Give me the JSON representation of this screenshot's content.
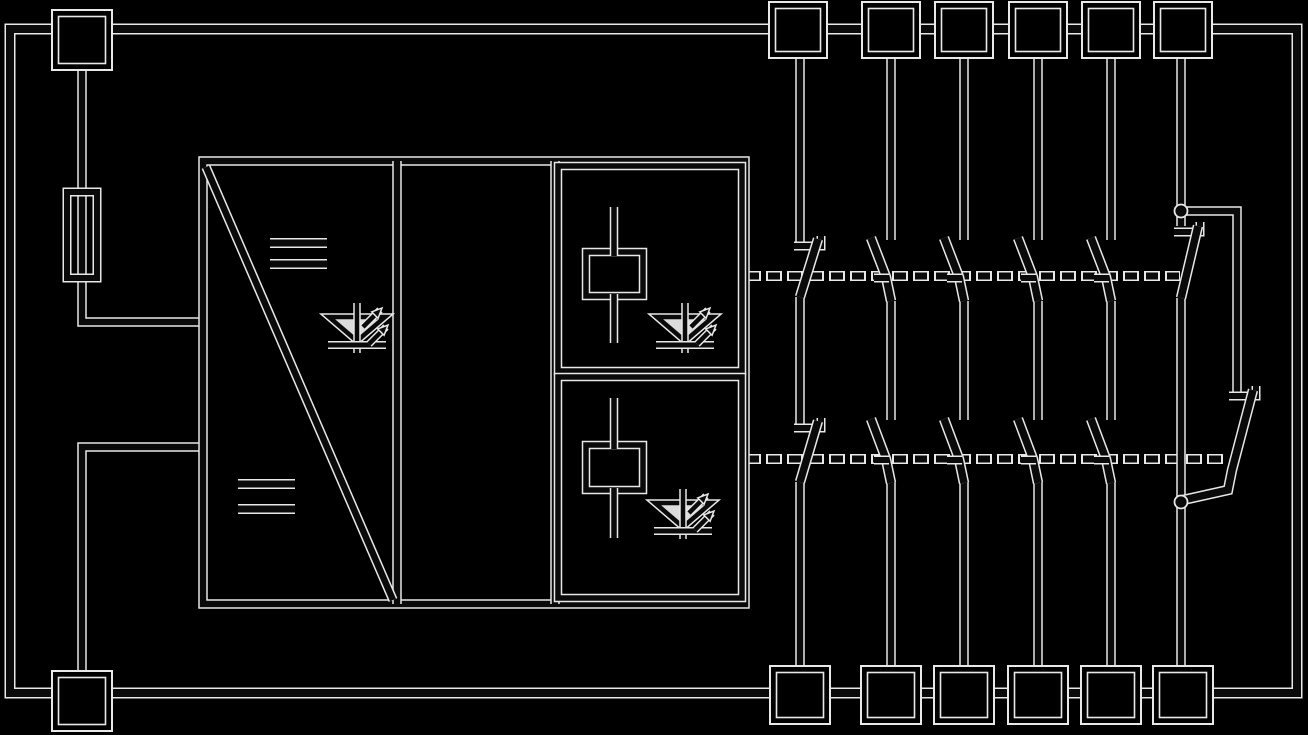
{
  "canvas": {
    "width": 1308,
    "height": 735,
    "background_color": "#000000",
    "ink_color": "#0a0a0a",
    "halo_color": "#e8e8e8",
    "led_fill_color": "#dcdcdc",
    "halo_extra_width": 3
  },
  "schematic": {
    "border": {
      "name": "outer-border",
      "d": "M10,29 L1297,29 L1297,693 L10,693 Z",
      "w": 8
    },
    "dashed_links": [
      {
        "name": "actuator-link-relay1",
        "d": "M747,276 L1180,276",
        "w": 7,
        "ink_dash": "12 9",
        "halo_dash": "16 5",
        "halo_offset": 2
      },
      {
        "name": "actuator-link-relay2",
        "d": "M747,459 L1228,459",
        "w": 7,
        "ink_dash": "12 9",
        "halo_dash": "16 5",
        "halo_offset": 2
      }
    ],
    "wires": [
      {
        "name": "supply-feed-wire",
        "d": "M82,66 L82,322 L204,322",
        "w": 6.5
      },
      {
        "name": "supply-return-wire",
        "d": "M204,447 L82,447 L82,675",
        "w": 6.5
      },
      {
        "name": "col1-top-wire",
        "d": "M800,58 L800,246",
        "w": 6.5
      },
      {
        "name": "col1-mid-wire",
        "d": "M800,297 L800,428",
        "w": 6.5
      },
      {
        "name": "col1-bottom-wire",
        "d": "M800,482 L800,670",
        "w": 6.5
      },
      {
        "name": "col2-top-wire",
        "d": "M891,58 L891,240",
        "w": 6.5
      },
      {
        "name": "col2-mid-wire",
        "d": "M891,301 L891,420",
        "w": 6.5
      },
      {
        "name": "col2-bottom-wire",
        "d": "M891,482 L891,670",
        "w": 6.5
      },
      {
        "name": "col3-top-wire",
        "d": "M964,58 L964,240",
        "w": 6.5
      },
      {
        "name": "col3-mid-wire",
        "d": "M964,301 L964,420",
        "w": 6.5
      },
      {
        "name": "col3-bottom-wire",
        "d": "M964,482 L964,670",
        "w": 6.5
      },
      {
        "name": "col4-top-wire",
        "d": "M1038,58 L1038,240",
        "w": 6.5
      },
      {
        "name": "col4-mid-wire",
        "d": "M1038,301 L1038,420",
        "w": 6.5
      },
      {
        "name": "col4-bottom-wire",
        "d": "M1038,482 L1038,670",
        "w": 6.5
      },
      {
        "name": "col5-top-wire",
        "d": "M1111,58 L1111,240",
        "w": 6.5
      },
      {
        "name": "col5-mid-wire",
        "d": "M1111,301 L1111,420",
        "w": 6.5
      },
      {
        "name": "col5-bottom-wire",
        "d": "M1111,482 L1111,670",
        "w": 6.5
      },
      {
        "name": "col6-top-wire",
        "d": "M1181,58 L1181,226",
        "w": 6.5
      },
      {
        "name": "col6-main-wire",
        "d": "M1181,298 L1181,670",
        "w": 6.5
      },
      {
        "name": "col6-branch-wire",
        "d": "M1181,211 L1237,211 L1237,396",
        "w": 6.5
      }
    ],
    "block_shapes": [
      {
        "name": "converter-block-outline",
        "type": "rect",
        "x": 203,
        "y": 161,
        "w": 542,
        "h": 443,
        "sw": 6.5
      },
      {
        "name": "block-divider-left",
        "type": "path",
        "d": "M397,161 L397,604",
        "sw": 6.5
      },
      {
        "name": "block-divider-right",
        "type": "path",
        "d": "M555,161 L555,604",
        "sw": 6.5
      },
      {
        "name": "converter-diagonal",
        "type": "path",
        "d": "M206,167 L393,600",
        "sw": 6.5
      },
      {
        "name": "dc-mark-top-bar1",
        "type": "path",
        "d": "M270,243 L327,243",
        "sw": 7
      },
      {
        "name": "dc-mark-top-bar2",
        "type": "path",
        "d": "M270,264 L327,264",
        "sw": 7
      },
      {
        "name": "dc-mark-bottom-bar1",
        "type": "path",
        "d": "M238,484 L295,484",
        "sw": 7
      },
      {
        "name": "dc-mark-bottom-bar2",
        "type": "path",
        "d": "M238,509 L295,509",
        "sw": 7
      },
      {
        "name": "relay1-compartment",
        "type": "rect",
        "x": 558,
        "y": 166,
        "w": 184,
        "h": 205,
        "sw": 5.5
      },
      {
        "name": "relay2-compartment",
        "type": "rect",
        "x": 558,
        "y": 377,
        "w": 184,
        "h": 221,
        "sw": 5.5
      },
      {
        "name": "relay1-coil-box",
        "type": "rect",
        "x": 586,
        "y": 252,
        "w": 57,
        "h": 44,
        "sw": 5.5
      },
      {
        "name": "relay2-coil-box",
        "type": "rect",
        "x": 586,
        "y": 445,
        "w": 57,
        "h": 45,
        "sw": 5.5
      },
      {
        "name": "fuse-body",
        "type": "rect",
        "x": 67,
        "y": 192,
        "w": 30,
        "h": 86,
        "sw": 6
      }
    ],
    "coil_wires": [
      {
        "name": "relay1-coil-lead-top",
        "d": "M614,207 L614,256",
        "w": 5.5
      },
      {
        "name": "relay1-coil-lead-bottom",
        "d": "M614,294 L614,343",
        "w": 5.5
      },
      {
        "name": "relay2-coil-lead-top",
        "d": "M614,398 L614,449",
        "w": 5.5
      },
      {
        "name": "relay2-coil-lead-bottom",
        "d": "M614,488 L614,538",
        "w": 5.5
      }
    ],
    "contacts": [
      {
        "name": "col1-nc-seat-upper",
        "d": "M794,246 L821,246 L821,236",
        "w": 6
      },
      {
        "name": "col1-nc-blade-upper",
        "d": "M818,239 L800,297",
        "w": 7.5
      },
      {
        "name": "col1-nc-seat-lower",
        "d": "M794,428 L821,428 L821,418",
        "w": 6
      },
      {
        "name": "col1-nc-blade-lower",
        "d": "M818,421 L800,482",
        "w": 7.5
      },
      {
        "name": "col2-no-blade-upper",
        "d": "M871,238 L886,277 L891,301",
        "w": 7.5
      },
      {
        "name": "col2-no-tick-upper",
        "d": "M874,278 L889,278",
        "w": 6
      },
      {
        "name": "col2-no-blade-lower",
        "d": "M871,419 L886,459 L891,483",
        "w": 7.5
      },
      {
        "name": "col2-no-tick-lower",
        "d": "M874,460 L889,460",
        "w": 6
      },
      {
        "name": "col3-no-blade-upper",
        "d": "M944,238 L959,277 L964,301",
        "w": 7.5
      },
      {
        "name": "col3-no-tick-upper",
        "d": "M947,278 L962,278",
        "w": 6
      },
      {
        "name": "col3-no-blade-lower",
        "d": "M944,419 L959,459 L964,483",
        "w": 7.5
      },
      {
        "name": "col3-no-tick-lower",
        "d": "M947,460 L962,460",
        "w": 6
      },
      {
        "name": "col4-no-blade-upper",
        "d": "M1018,238 L1033,277 L1038,301",
        "w": 7.5
      },
      {
        "name": "col4-no-tick-upper",
        "d": "M1021,278 L1036,278",
        "w": 6
      },
      {
        "name": "col4-no-blade-lower",
        "d": "M1018,419 L1033,459 L1038,483",
        "w": 7.5
      },
      {
        "name": "col4-no-tick-lower",
        "d": "M1021,460 L1036,460",
        "w": 6
      },
      {
        "name": "col5-no-blade-upper",
        "d": "M1091,238 L1106,277 L1111,301",
        "w": 7.5
      },
      {
        "name": "col5-no-tick-upper",
        "d": "M1094,278 L1109,278",
        "w": 6
      },
      {
        "name": "col5-no-blade-lower",
        "d": "M1091,419 L1106,459 L1111,483",
        "w": 7.5
      },
      {
        "name": "col5-no-tick-lower",
        "d": "M1094,460 L1109,460",
        "w": 6
      },
      {
        "name": "col6-nc-seat-upper",
        "d": "M1174,232 L1200,232 L1200,222",
        "w": 6
      },
      {
        "name": "col6-nc-blade-upper",
        "d": "M1198,226 L1181,298",
        "w": 7.5
      },
      {
        "name": "col6-nc-seat-lower",
        "d": "M1229,396 L1256,396 L1256,386",
        "w": 6
      },
      {
        "name": "col6-nc-blade-lower",
        "d": "M1253,390 L1232,470 L1228,490 L1183,500",
        "w": 7.5
      }
    ],
    "terminals": [
      {
        "name": "terminal-top-left",
        "x": 52,
        "y": 10,
        "w": 60,
        "h": 60
      },
      {
        "name": "terminal-top-1",
        "x": 769,
        "y": 2,
        "w": 58,
        "h": 56
      },
      {
        "name": "terminal-top-2",
        "x": 862,
        "y": 2,
        "w": 58,
        "h": 56
      },
      {
        "name": "terminal-top-3",
        "x": 935,
        "y": 2,
        "w": 58,
        "h": 56
      },
      {
        "name": "terminal-top-4",
        "x": 1009,
        "y": 2,
        "w": 58,
        "h": 56
      },
      {
        "name": "terminal-top-5",
        "x": 1082,
        "y": 2,
        "w": 58,
        "h": 56
      },
      {
        "name": "terminal-top-6",
        "x": 1154,
        "y": 2,
        "w": 58,
        "h": 56
      },
      {
        "name": "terminal-bottom-left",
        "x": 52,
        "y": 671,
        "w": 60,
        "h": 60
      },
      {
        "name": "terminal-bottom-1",
        "x": 770,
        "y": 666,
        "w": 60,
        "h": 58
      },
      {
        "name": "terminal-bottom-2",
        "x": 861,
        "y": 666,
        "w": 60,
        "h": 58
      },
      {
        "name": "terminal-bottom-3",
        "x": 934,
        "y": 666,
        "w": 60,
        "h": 58
      },
      {
        "name": "terminal-bottom-4",
        "x": 1008,
        "y": 666,
        "w": 60,
        "h": 58
      },
      {
        "name": "terminal-bottom-5",
        "x": 1081,
        "y": 666,
        "w": 60,
        "h": 58
      },
      {
        "name": "terminal-bottom-6",
        "x": 1153,
        "y": 666,
        "w": 60,
        "h": 58
      }
    ],
    "junction_dots": [
      {
        "name": "col6-junction-top",
        "cx": 1181,
        "cy": 211,
        "r": 6.5
      },
      {
        "name": "col6-junction-bottom",
        "cx": 1181,
        "cy": 502,
        "r": 6.5
      }
    ],
    "leds": [
      {
        "name": "led-power-indicator",
        "cx": 357,
        "cy": 325
      },
      {
        "name": "led-relay1-indicator",
        "cx": 685,
        "cy": 325
      },
      {
        "name": "led-relay2-indicator",
        "cx": 683,
        "cy": 511
      }
    ],
    "led_template": {
      "triangle": [
        [
          -28,
          -8
        ],
        [
          28,
          -8
        ],
        [
          0,
          16
        ]
      ],
      "triangle_sw": 4.5,
      "vline": "M0,-22 L0,28",
      "vline_w": 4.5,
      "cathode_bar": "M-29,20 L29,20",
      "cathode_w": 5,
      "arrows": [
        {
          "shaft": "M6,2 L23,-15",
          "tip": [
            25,
            -17
          ]
        },
        {
          "shaft": "M12,19 L29,2",
          "tip": [
            31,
            0
          ]
        }
      ],
      "arrow_w": 4.5,
      "arrow_head": [
        [
          0,
          0
        ],
        [
          -3.9,
          10.3
        ],
        [
          -10.3,
          3.9
        ]
      ]
    }
  }
}
